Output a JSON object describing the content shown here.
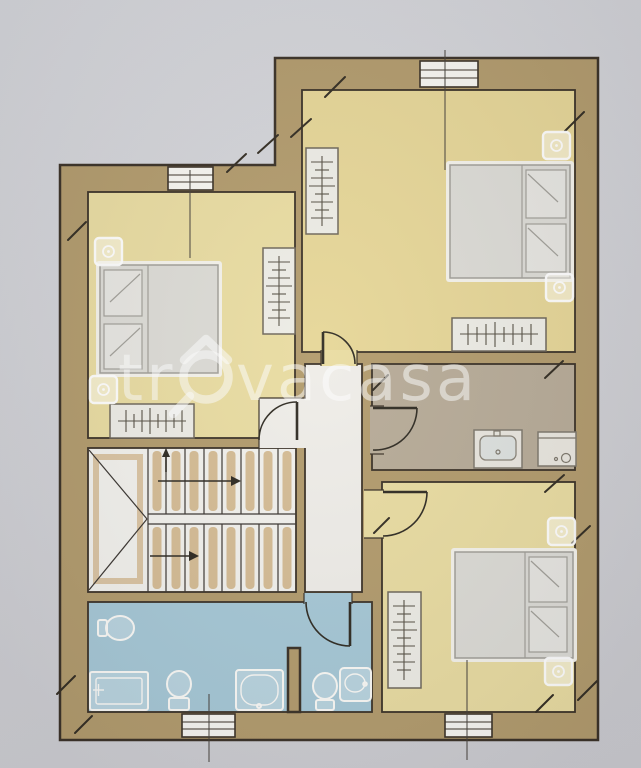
{
  "image": {
    "type": "architectural-floor-plan-photo",
    "watermark": {
      "prefix": "tr",
      "suffix": "vacasa",
      "logo_icon": "magnifier-house-logo"
    }
  },
  "palette": {
    "bg1": "#d6d7db",
    "bg2": "#cbcbcf",
    "wall": "#b29b6c",
    "wallStroke": "#3a3126",
    "roomYellow": "#e9dca1",
    "roomYellow2": "#e6d697",
    "bathBlue": "#a6c8d6",
    "bathTaupe": "#b7ab97",
    "floorWhite": "#efede8",
    "stairFloor": "#f2f1ec",
    "treadTan": "#c9a771",
    "furnGray": "#dcdbd5",
    "furnEdge": "#a19f98",
    "halo": "#f4f2ea",
    "fixtureWhite": "#fbfaf6",
    "wardrobeFill": "#edece5",
    "hatch": "#565044",
    "watermark": "rgba(255,255,255,0.52)"
  }
}
